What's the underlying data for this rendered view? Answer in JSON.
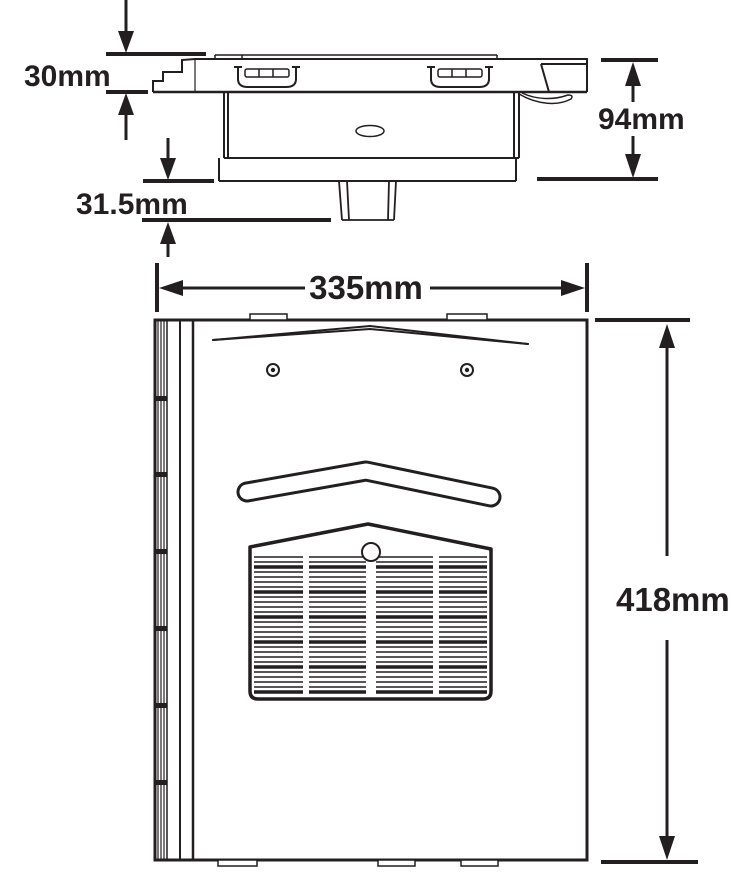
{
  "diagram": {
    "type": "technical-drawing",
    "units": "mm",
    "colors": {
      "line": "#231f20",
      "background": "#ffffff"
    },
    "dimensions": {
      "plate_thickness": "30mm",
      "spigot_depth": "31.5mm",
      "overall_depth": "94mm",
      "overall_width": "335mm",
      "overall_height": "418mm"
    },
    "views": {
      "top_view": "top-profile-view",
      "front_view": "front-view"
    },
    "features": [
      "wall-bracket",
      "mounting-plate",
      "keyhole-slot",
      "cable-clip",
      "heater-body",
      "outlet-spigot",
      "hinge-strip",
      "panel-crease",
      "screw-hole",
      "air-deflector-band",
      "outlet-grille",
      "grille-screw",
      "mounting-tab"
    ]
  }
}
